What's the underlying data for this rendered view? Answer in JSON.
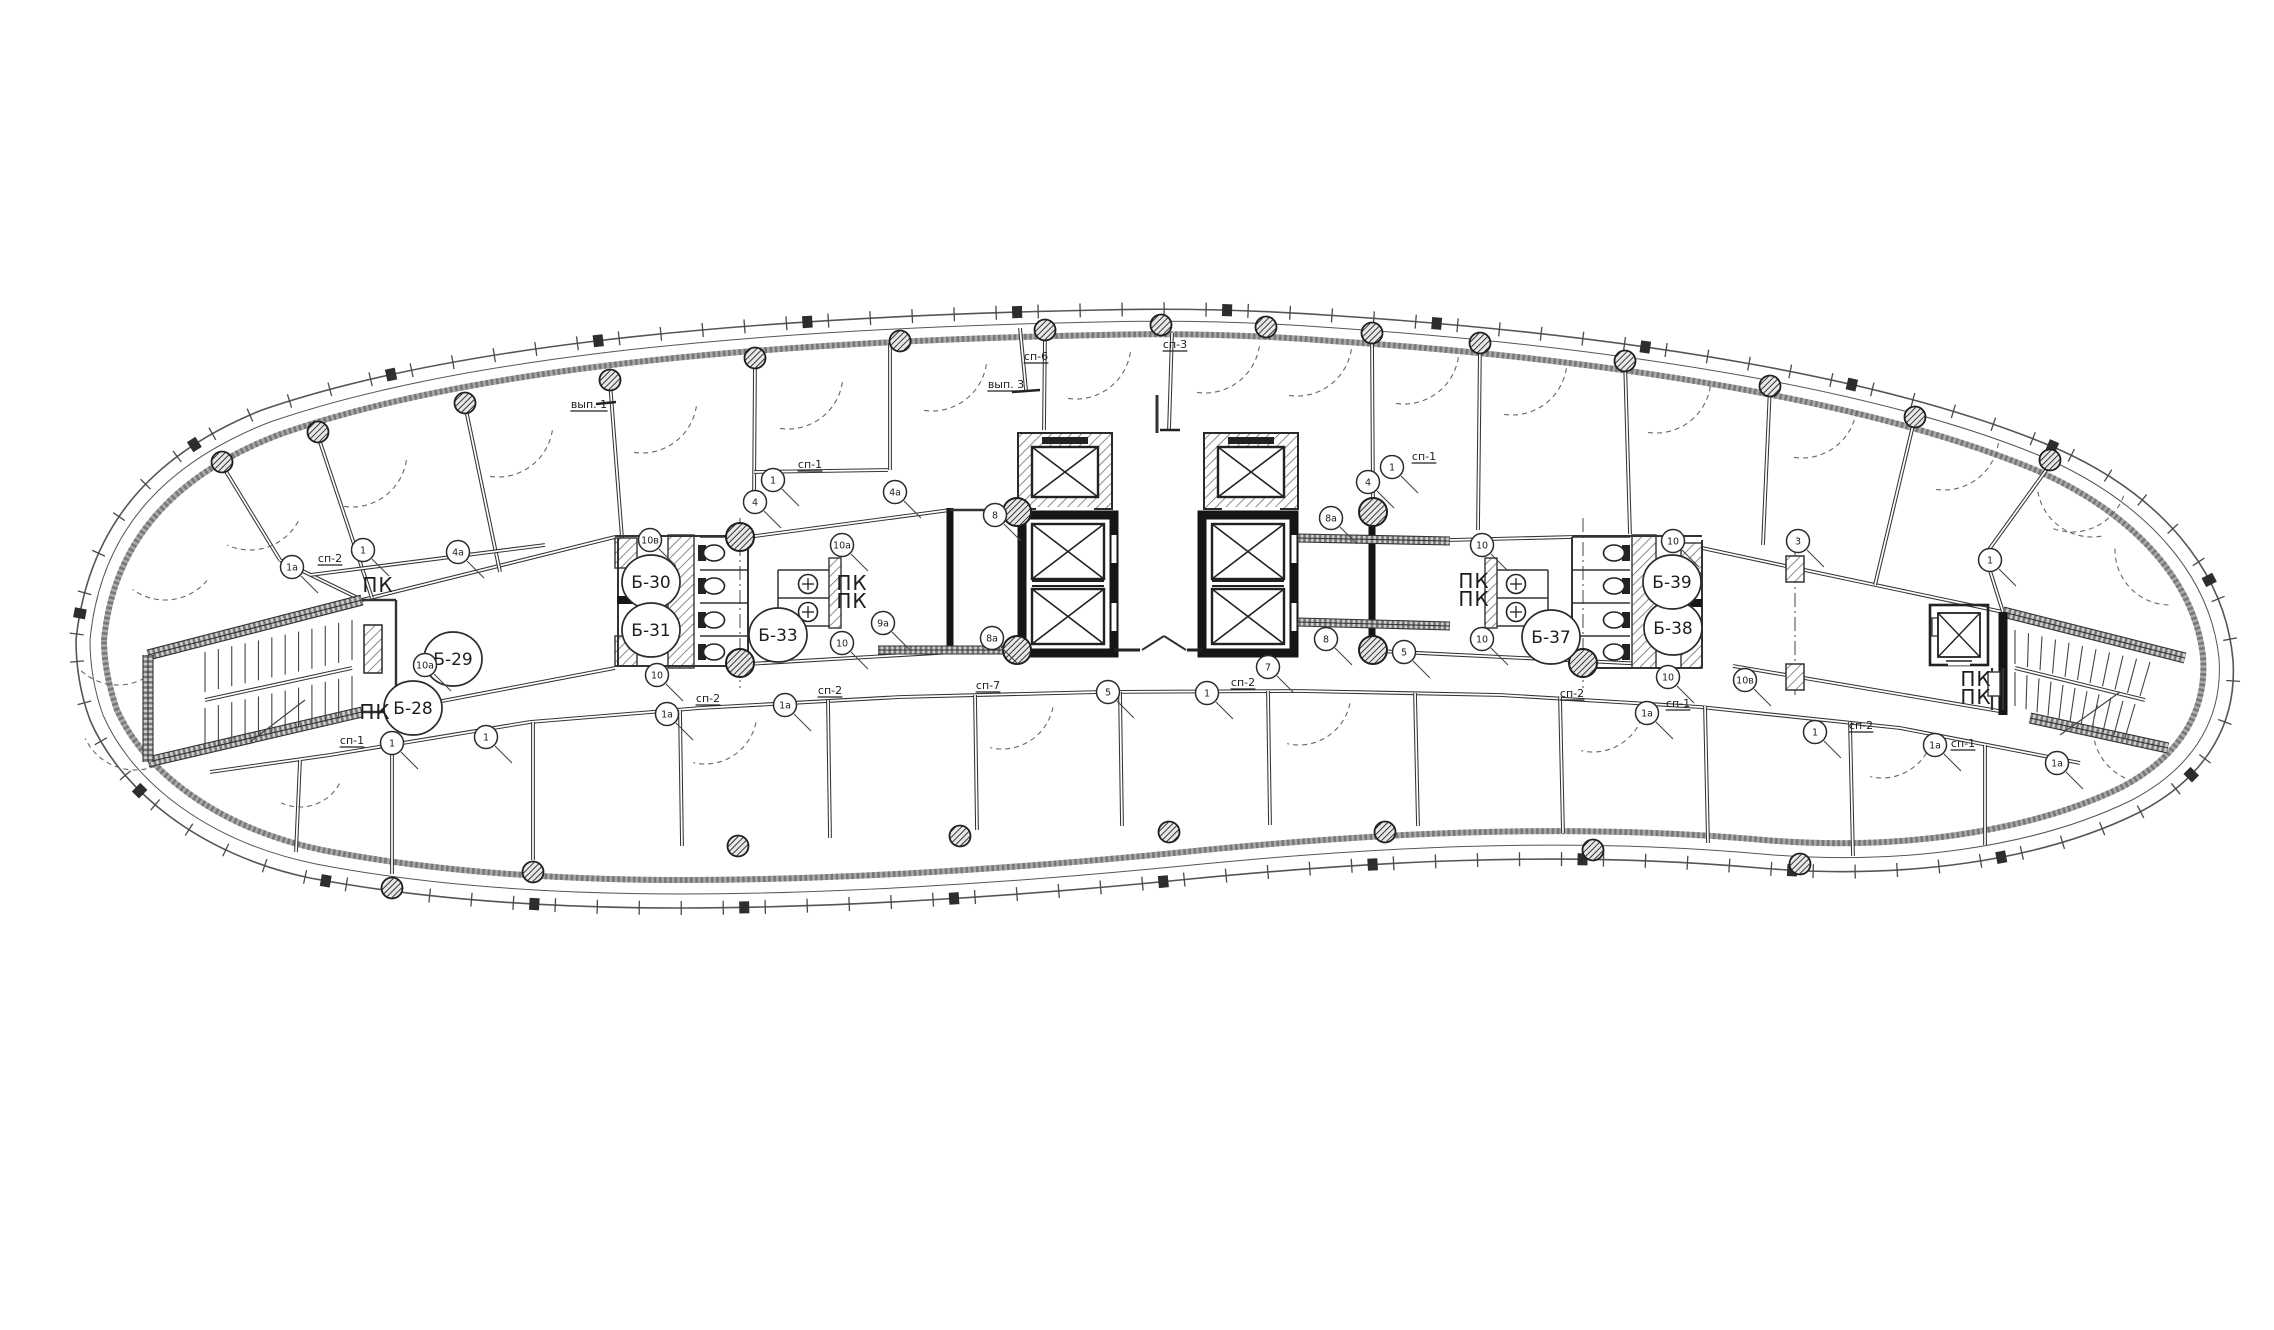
{
  "drawing": {
    "type": "architectural-floor-plan",
    "colors": {
      "line": "#3b3b3b",
      "black_wall": "#161616",
      "hatch_wall": "#8c8c8c",
      "background": "#ffffff"
    },
    "room_labels": [
      {
        "text": "Б-28",
        "x": 413,
        "y": 708
      },
      {
        "text": "Б-29",
        "x": 453,
        "y": 659
      },
      {
        "text": "Б-30",
        "x": 651,
        "y": 582
      },
      {
        "text": "Б-31",
        "x": 651,
        "y": 630
      },
      {
        "text": "Б-33",
        "x": 778,
        "y": 635
      },
      {
        "text": "Б-37",
        "x": 1551,
        "y": 637
      },
      {
        "text": "Б-38",
        "x": 1673,
        "y": 628
      },
      {
        "text": "Б-39",
        "x": 1672,
        "y": 582
      }
    ],
    "pk_labels": [
      {
        "text": "ПК",
        "x": 378,
        "y": 585
      },
      {
        "text": "ПК",
        "x": 375,
        "y": 712
      },
      {
        "text": "ПК",
        "x": 852,
        "y": 583
      },
      {
        "text": "ПК",
        "x": 852,
        "y": 601
      },
      {
        "text": "ПК",
        "x": 1474,
        "y": 581
      },
      {
        "text": "ПК",
        "x": 1474,
        "y": 599
      },
      {
        "text": "ПК",
        "x": 1976,
        "y": 679
      },
      {
        "text": "ПК",
        "x": 1976,
        "y": 697
      }
    ],
    "utility_labels": [
      {
        "text": "сп-1",
        "x": 810,
        "y": 468
      },
      {
        "text": "сп-1",
        "x": 1424,
        "y": 460
      },
      {
        "text": "сп-1",
        "x": 352,
        "y": 744
      },
      {
        "text": "сп-1",
        "x": 1678,
        "y": 707
      },
      {
        "text": "сп-1",
        "x": 1963,
        "y": 747
      },
      {
        "text": "сп-2",
        "x": 330,
        "y": 562
      },
      {
        "text": "сп-2",
        "x": 708,
        "y": 702
      },
      {
        "text": "сп-2",
        "x": 830,
        "y": 694
      },
      {
        "text": "сп-2",
        "x": 1243,
        "y": 686
      },
      {
        "text": "сп-2",
        "x": 1572,
        "y": 697
      },
      {
        "text": "сп-2",
        "x": 1861,
        "y": 729
      },
      {
        "text": "сп-3",
        "x": 1175,
        "y": 348
      },
      {
        "text": "сп-6",
        "x": 1036,
        "y": 360
      },
      {
        "text": "сп-7",
        "x": 988,
        "y": 689
      },
      {
        "text": "вып. 1",
        "x": 589,
        "y": 408
      },
      {
        "text": "вып. 3",
        "x": 1006,
        "y": 388
      }
    ],
    "keynote_markers": [
      {
        "text": "1",
        "x": 363,
        "y": 550
      },
      {
        "text": "1",
        "x": 392,
        "y": 743
      },
      {
        "text": "1",
        "x": 486,
        "y": 737
      },
      {
        "text": "1",
        "x": 773,
        "y": 480
      },
      {
        "text": "1",
        "x": 1392,
        "y": 467
      },
      {
        "text": "1",
        "x": 1207,
        "y": 693
      },
      {
        "text": "1",
        "x": 1815,
        "y": 732
      },
      {
        "text": "1",
        "x": 1990,
        "y": 560
      },
      {
        "text": "1а",
        "x": 292,
        "y": 567
      },
      {
        "text": "1а",
        "x": 667,
        "y": 714
      },
      {
        "text": "1а",
        "x": 785,
        "y": 705
      },
      {
        "text": "1а",
        "x": 1647,
        "y": 713
      },
      {
        "text": "1а",
        "x": 1935,
        "y": 745
      },
      {
        "text": "1а",
        "x": 2057,
        "y": 763
      },
      {
        "text": "3",
        "x": 1798,
        "y": 541
      },
      {
        "text": "4",
        "x": 755,
        "y": 502
      },
      {
        "text": "4",
        "x": 1368,
        "y": 482
      },
      {
        "text": "4а",
        "x": 458,
        "y": 552
      },
      {
        "text": "4а",
        "x": 895,
        "y": 492
      },
      {
        "text": "5",
        "x": 1108,
        "y": 692
      },
      {
        "text": "5",
        "x": 1404,
        "y": 652
      },
      {
        "text": "7",
        "x": 1268,
        "y": 667
      },
      {
        "text": "8",
        "x": 995,
        "y": 515
      },
      {
        "text": "8",
        "x": 1326,
        "y": 639
      },
      {
        "text": "8а",
        "x": 992,
        "y": 638
      },
      {
        "text": "8а",
        "x": 1331,
        "y": 518
      },
      {
        "text": "9а",
        "x": 883,
        "y": 623
      },
      {
        "text": "10",
        "x": 657,
        "y": 675
      },
      {
        "text": "10",
        "x": 842,
        "y": 643
      },
      {
        "text": "10",
        "x": 1482,
        "y": 545
      },
      {
        "text": "10",
        "x": 1482,
        "y": 639
      },
      {
        "text": "10",
        "x": 1668,
        "y": 677
      },
      {
        "text": "10",
        "x": 1673,
        "y": 541
      },
      {
        "text": "10а",
        "x": 425,
        "y": 665
      },
      {
        "text": "10а",
        "x": 842,
        "y": 545
      },
      {
        "text": "10в",
        "x": 650,
        "y": 540
      },
      {
        "text": "10в",
        "x": 1745,
        "y": 680
      }
    ]
  }
}
